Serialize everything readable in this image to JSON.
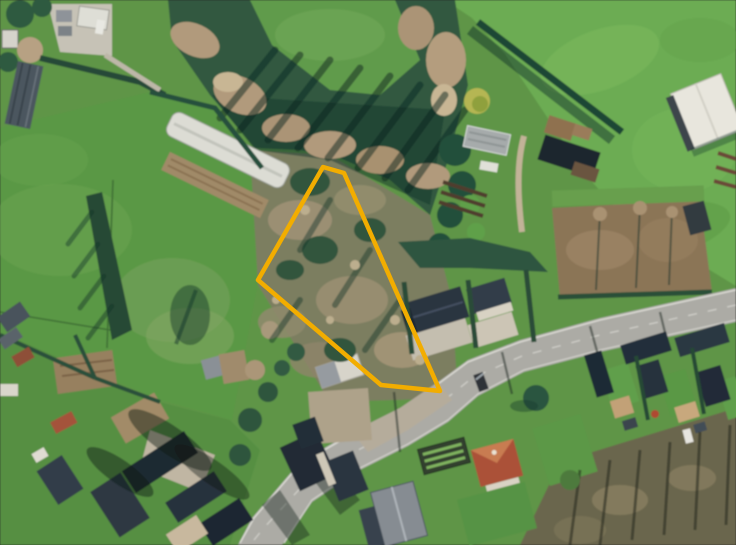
{
  "meta": {
    "type": "aerial-photograph",
    "description": "Oblique-free orthophoto of a Belgian village edge: a vacant overgrown building plot outlined in orange sits between pastures, a wooded strip and a main road lined with slate-roofed houses.",
    "width_px": 736,
    "height_px": 545
  },
  "parcel_overlay": {
    "outline_color": "#F2AD00",
    "stroke_width": 4.5,
    "points": "323,167 344,173 440,391 381,385 258,280"
  },
  "palette": {
    "bright_field_green": "#6CAC52",
    "pasture_green": "#5A9845",
    "woodland_dark_green": "#315940",
    "shadow_teal": "#14362B",
    "scrub_olive": "#7C7E60",
    "bare_canopy_tan": "#B19A7B",
    "soil_brown": "#8B7557",
    "road_gray": "#ACABA5",
    "roof_slate": "#2A3440",
    "roof_red": "#AB5138",
    "barn_white": "#E8E6DD"
  },
  "features": {
    "parcel": "parcel-boundary",
    "road": "main-road",
    "farm": [
      "polytunnel-greenhouse",
      "farm-barn",
      "tilled-strip"
    ],
    "landmarks": [
      "white-barn",
      "red-roof-house",
      "gray-roof-house",
      "brown-field",
      "allotment-rows"
    ],
    "terrain": [
      "pasture",
      "bright-field",
      "woodland",
      "scrub-plot",
      "village",
      "bottom-scrub"
    ]
  }
}
